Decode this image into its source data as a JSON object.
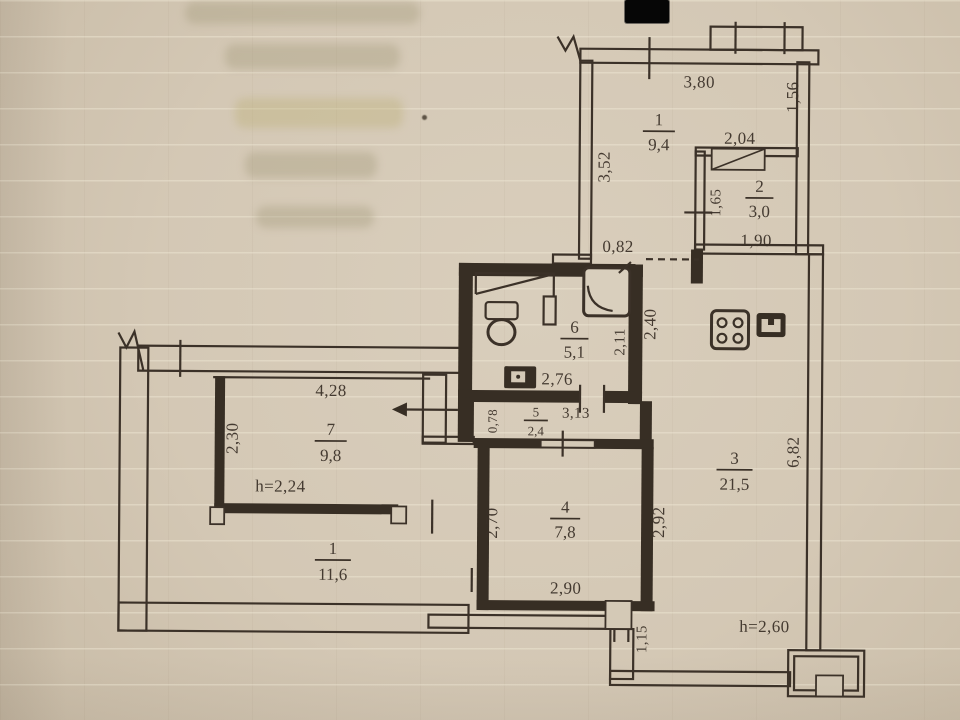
{
  "document": {
    "type": "scanned apartment floor plan"
  },
  "rooms": {
    "r1": {
      "num": "1",
      "area": "9,4"
    },
    "r2": {
      "num": "2",
      "area": "3,0"
    },
    "r3": {
      "num": "3",
      "area": "21,5"
    },
    "r4": {
      "num": "4",
      "area": "7,8"
    },
    "r5": {
      "num": "5",
      "area": "2,4"
    },
    "r6": {
      "num": "6",
      "area": "5,1"
    },
    "r7": {
      "num": "7",
      "area": "9,8"
    },
    "r1b": {
      "num": "1",
      "area": "11,6"
    }
  },
  "dims": {
    "d380": "3,80",
    "d156": "1,56",
    "d352": "3,52",
    "d204": "2,04",
    "d165": "1,65",
    "d190": "1,90",
    "d082": "0,82",
    "d240": "2,40",
    "d211": "2,11",
    "d276": "2,76",
    "d078": "0,78",
    "d313": "3,13",
    "d428": "4,28",
    "d230": "2,30",
    "d270": "2,70",
    "d292": "2,92",
    "d290": "2,90",
    "d682": "6,82",
    "d115": "1,15"
  },
  "heights": {
    "room7": "h=2,24",
    "room3": "h=2,60"
  },
  "colors": {
    "ink": "#3a3027",
    "paper": "#d5cab8",
    "redaction": "#000000"
  }
}
